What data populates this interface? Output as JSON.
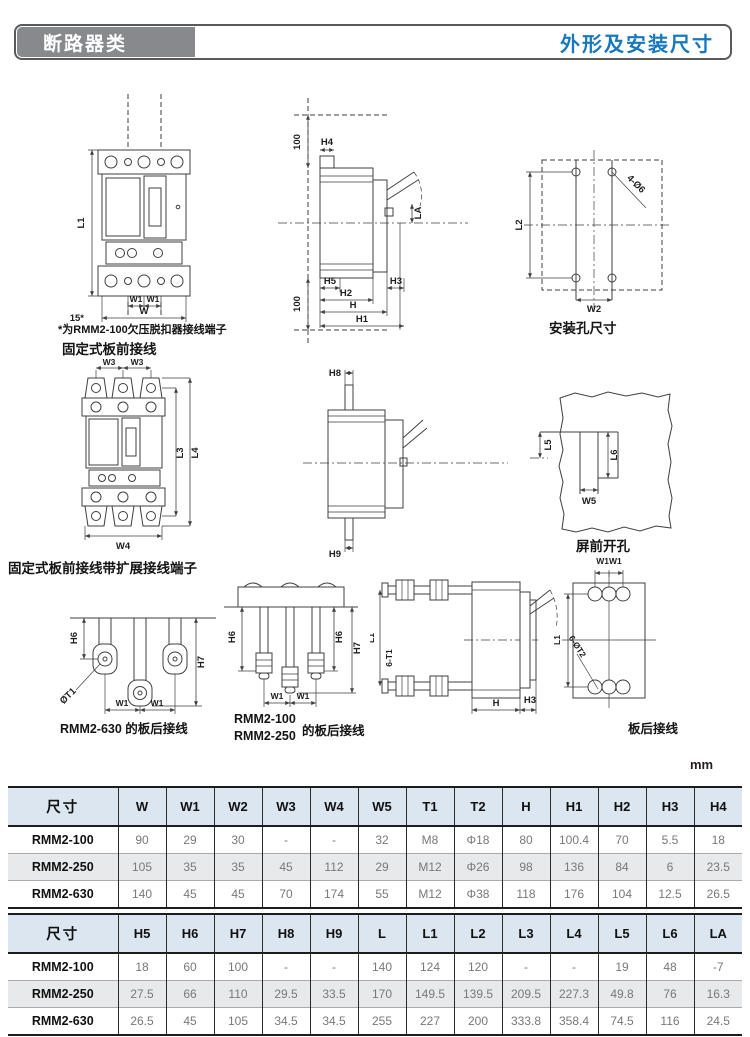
{
  "page": {
    "unit_label": "mm"
  },
  "header": {
    "category": "断路器类",
    "title": "外形及安装尺寸",
    "accent_color": "#1878bd",
    "category_bg": "#87898c"
  },
  "figures": {
    "front_view": {
      "note": "*为RMM2-100欠压脱扣器接线端子",
      "caption": "固定式板前接线",
      "labels": {
        "l1": "L1",
        "w1_left": "W1",
        "w1_right": "W1",
        "w": "W",
        "offset15": "15*"
      }
    },
    "side_view": {
      "labels": {
        "top_100": "100",
        "h4": "H4",
        "la": "LA",
        "h5": "H5",
        "h2": "H2",
        "h": "H",
        "h1": "H1",
        "h3": "H3",
        "bottom_100": "100"
      }
    },
    "mounting_holes": {
      "caption": "安装孔尺寸",
      "labels": {
        "holes": "4-Ø6",
        "l2": "L2",
        "w2": "W2"
      }
    },
    "front_view_extended": {
      "caption": "固定式板前接线带扩展接线端子",
      "labels": {
        "w3_left": "W3",
        "w3_right": "W3",
        "l3": "L3",
        "l4": "L4",
        "w4": "W4"
      }
    },
    "side_view_2": {
      "labels": {
        "h8": "H8",
        "h9": "H9"
      }
    },
    "panel_cutout": {
      "caption": "屏前开孔",
      "labels": {
        "l5": "L5",
        "l6": "L6",
        "w5": "W5"
      }
    },
    "rear_630": {
      "caption": "RMM2-630 的板后接线",
      "labels": {
        "h6": "H6",
        "phi_t1": "ØT1",
        "h7": "H7",
        "w1_left": "W1",
        "w1_right": "W1"
      }
    },
    "rear_100_250": {
      "caption_line1": "RMM2-100",
      "caption_line2": "RMM2-250",
      "caption_suffix": "的板后接线",
      "labels": {
        "h6_left": "H6",
        "h6_right": "H6",
        "h7": "H7",
        "w1_left": "W1",
        "w1_right": "W1"
      }
    },
    "rear_connection": {
      "caption": "板后接线",
      "labels": {
        "l1_side": "L1",
        "six_t1": "6-T1",
        "h": "H",
        "h3": "H3",
        "w1w1": "W1W1",
        "l1_rear": "L1",
        "six_phi_t2": "6-ØT2"
      }
    }
  },
  "tables": [
    {
      "name": "width-and-height-dimensions",
      "columns": [
        "尺寸",
        "W",
        "W1",
        "W2",
        "W3",
        "W4",
        "W5",
        "T1",
        "T2",
        "H",
        "H1",
        "H2",
        "H3",
        "H4"
      ],
      "rows": [
        {
          "label": "RMM2-100",
          "values": [
            "90",
            "29",
            "30",
            "-",
            "-",
            "32",
            "M8",
            "Φ18",
            "80",
            "100.4",
            "70",
            "5.5",
            "18"
          ]
        },
        {
          "label": "RMM2-250",
          "values": [
            "105",
            "35",
            "35",
            "45",
            "112",
            "29",
            "M12",
            "Φ26",
            "98",
            "136",
            "84",
            "6",
            "23.5"
          ]
        },
        {
          "label": "RMM2-630",
          "values": [
            "140",
            "45",
            "45",
            "70",
            "174",
            "55",
            "M12",
            "Φ38",
            "118",
            "176",
            "104",
            "12.5",
            "26.5"
          ]
        }
      ]
    },
    {
      "name": "height-and-length-dimensions",
      "columns": [
        "尺寸",
        "H5",
        "H6",
        "H7",
        "H8",
        "H9",
        "L",
        "L1",
        "L2",
        "L3",
        "L4",
        "L5",
        "L6",
        "LA"
      ],
      "rows": [
        {
          "label": "RMM2-100",
          "values": [
            "18",
            "60",
            "100",
            "-",
            "-",
            "140",
            "124",
            "120",
            "-",
            "-",
            "19",
            "48",
            "-7"
          ]
        },
        {
          "label": "RMM2-250",
          "values": [
            "27.5",
            "66",
            "110",
            "29.5",
            "33.5",
            "170",
            "149.5",
            "139.5",
            "209.5",
            "227.3",
            "49.8",
            "76",
            "16.3"
          ]
        },
        {
          "label": "RMM2-630",
          "values": [
            "26.5",
            "45",
            "105",
            "34.5",
            "34.5",
            "255",
            "227",
            "200",
            "333.8",
            "358.4",
            "74.5",
            "116",
            "24.5"
          ]
        }
      ]
    }
  ]
}
